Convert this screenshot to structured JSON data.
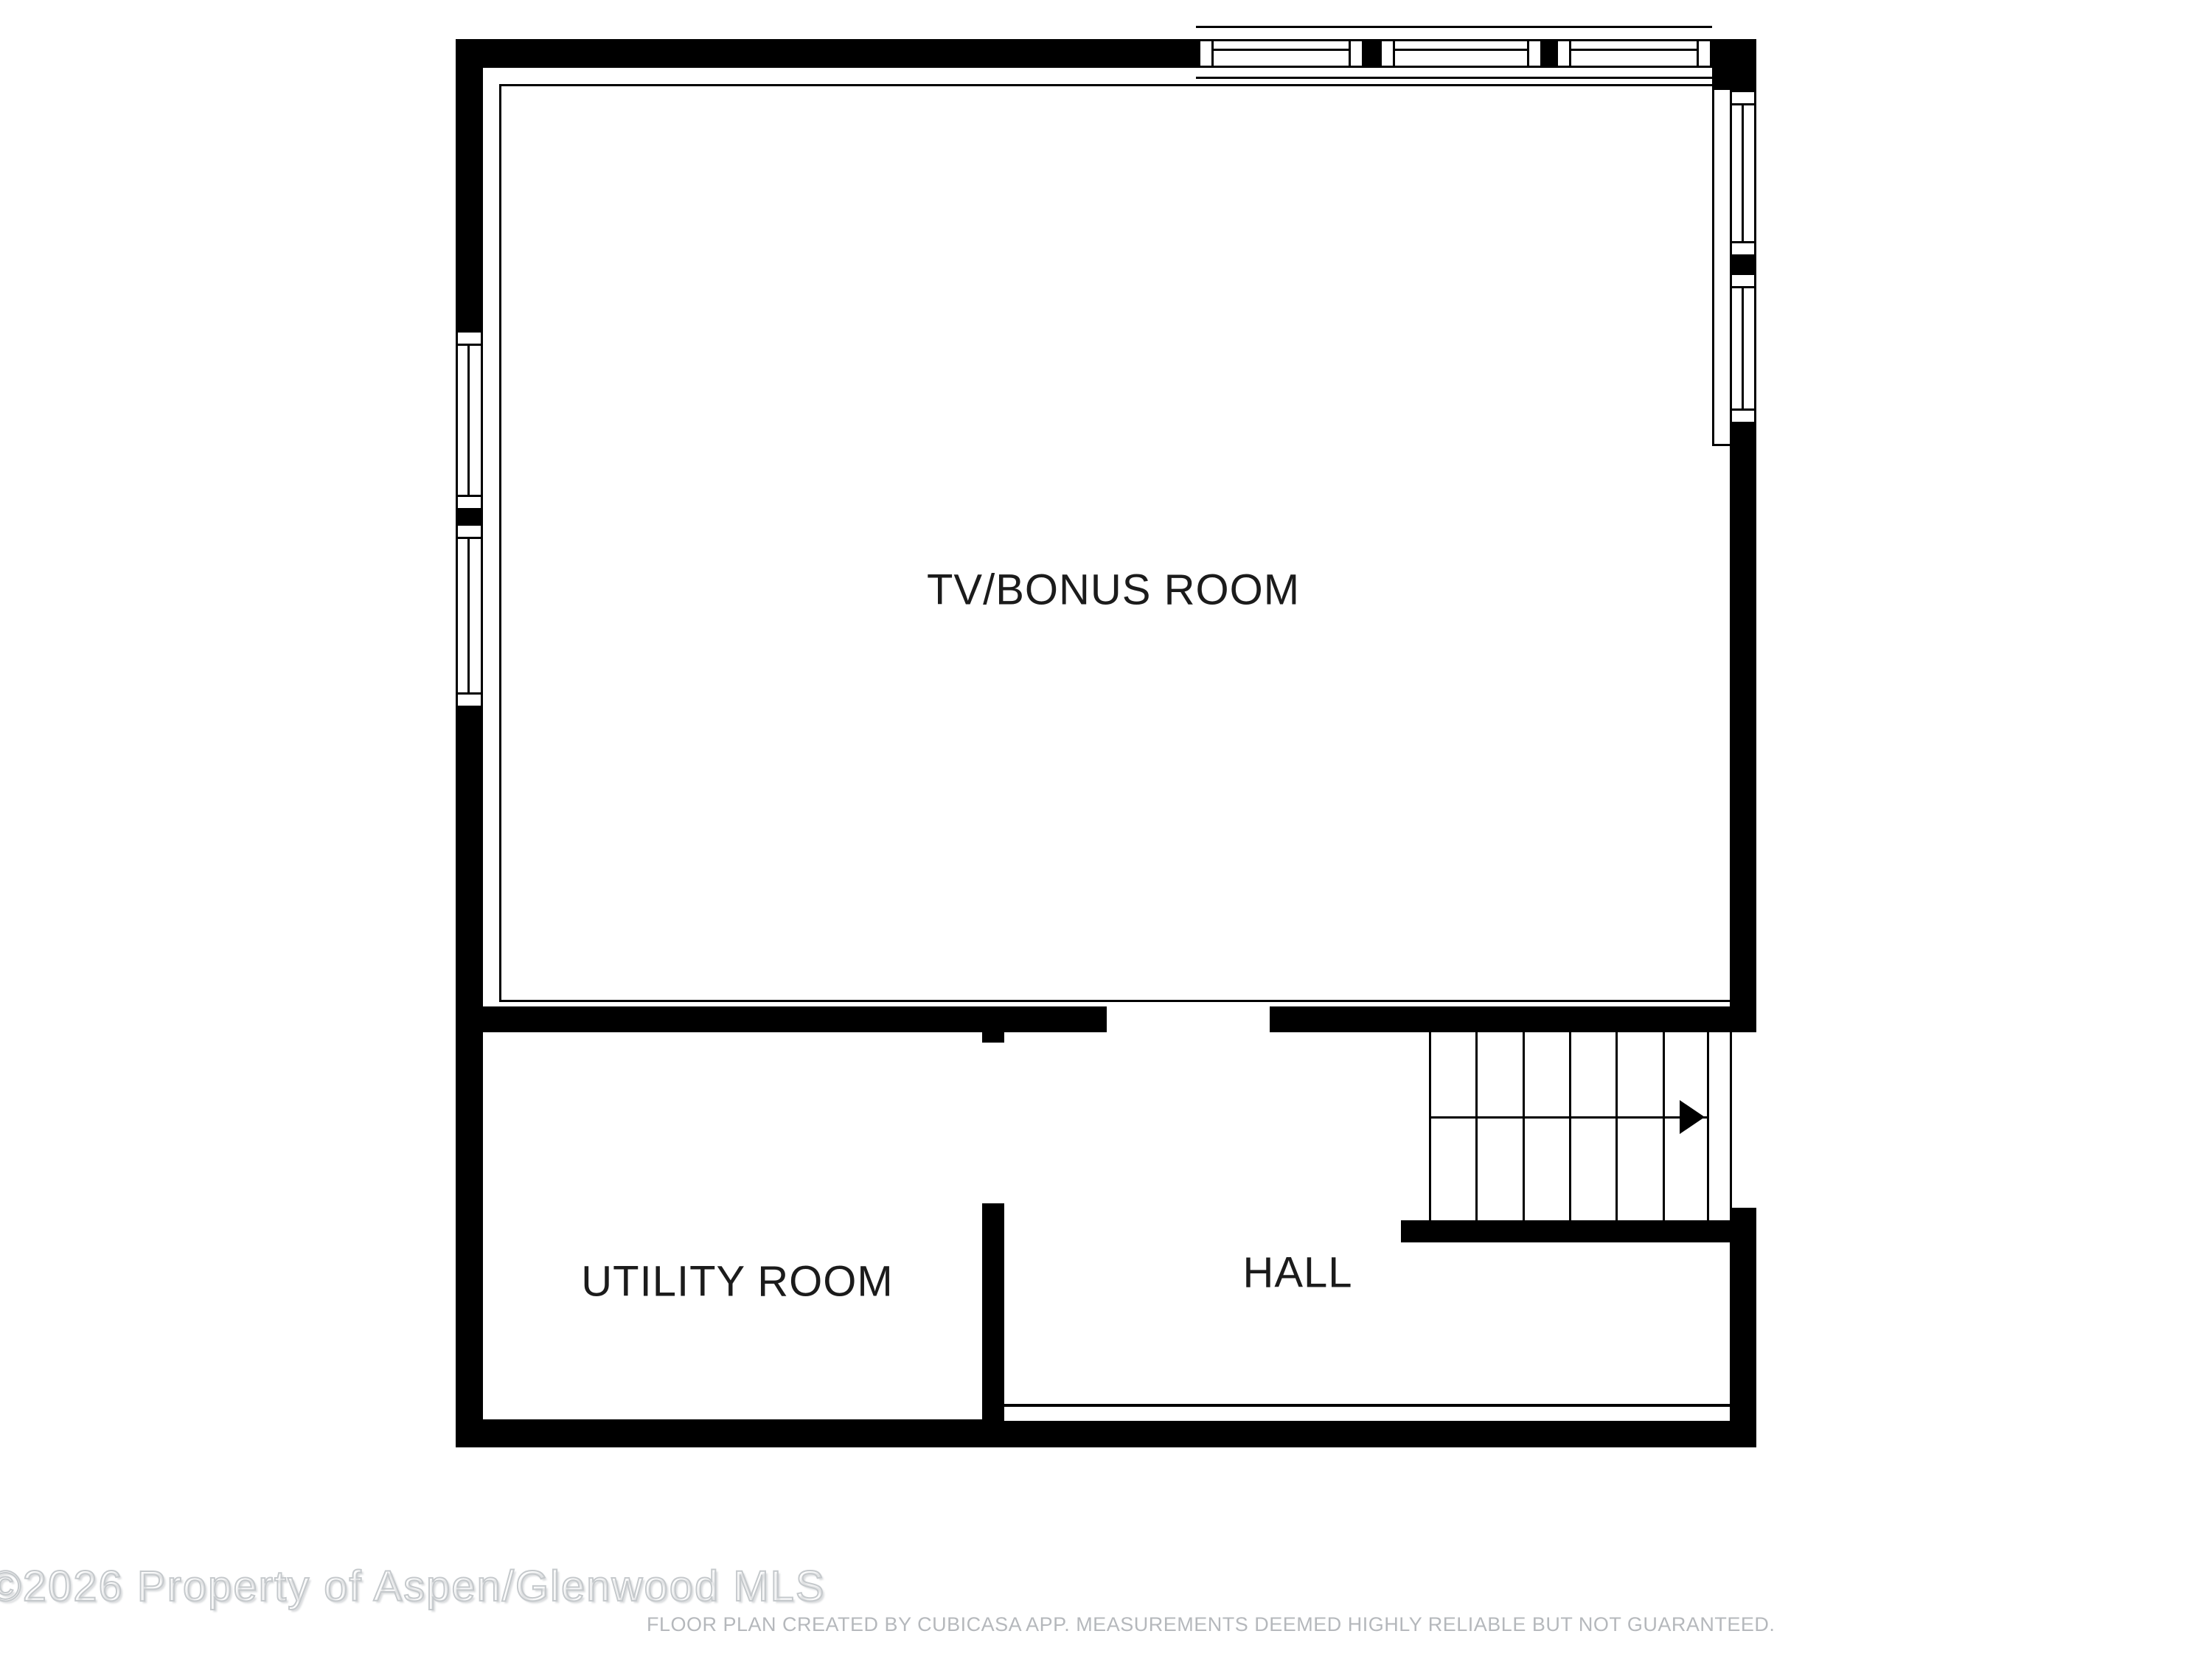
{
  "rooms": [
    {
      "id": "tv-bonus-room",
      "label": "TV/BONUS ROOM"
    },
    {
      "id": "utility-room",
      "label": "UTILITY ROOM"
    },
    {
      "id": "hall",
      "label": "HALL"
    }
  ],
  "stairs": {
    "direction": "right",
    "tread_columns": 6,
    "flights": 2
  },
  "windows": {
    "top_wall": 3,
    "left_wall": 2,
    "right_wall": 2
  },
  "watermark": {
    "text": "©2026 Property of Aspen/Glenwood MLS"
  },
  "footer": {
    "disclaimer": "FLOOR PLAN CREATED BY CUBICASA APP. MEASUREMENTS DEEMED HIGHLY RELIABLE BUT NOT GUARANTEED."
  },
  "colors": {
    "wall": "#000000",
    "background": "#ffffff",
    "label_text": "#1b1b1b",
    "watermark_outline": "#c5c9cc",
    "disclaimer_text": "#b5b8bc"
  }
}
